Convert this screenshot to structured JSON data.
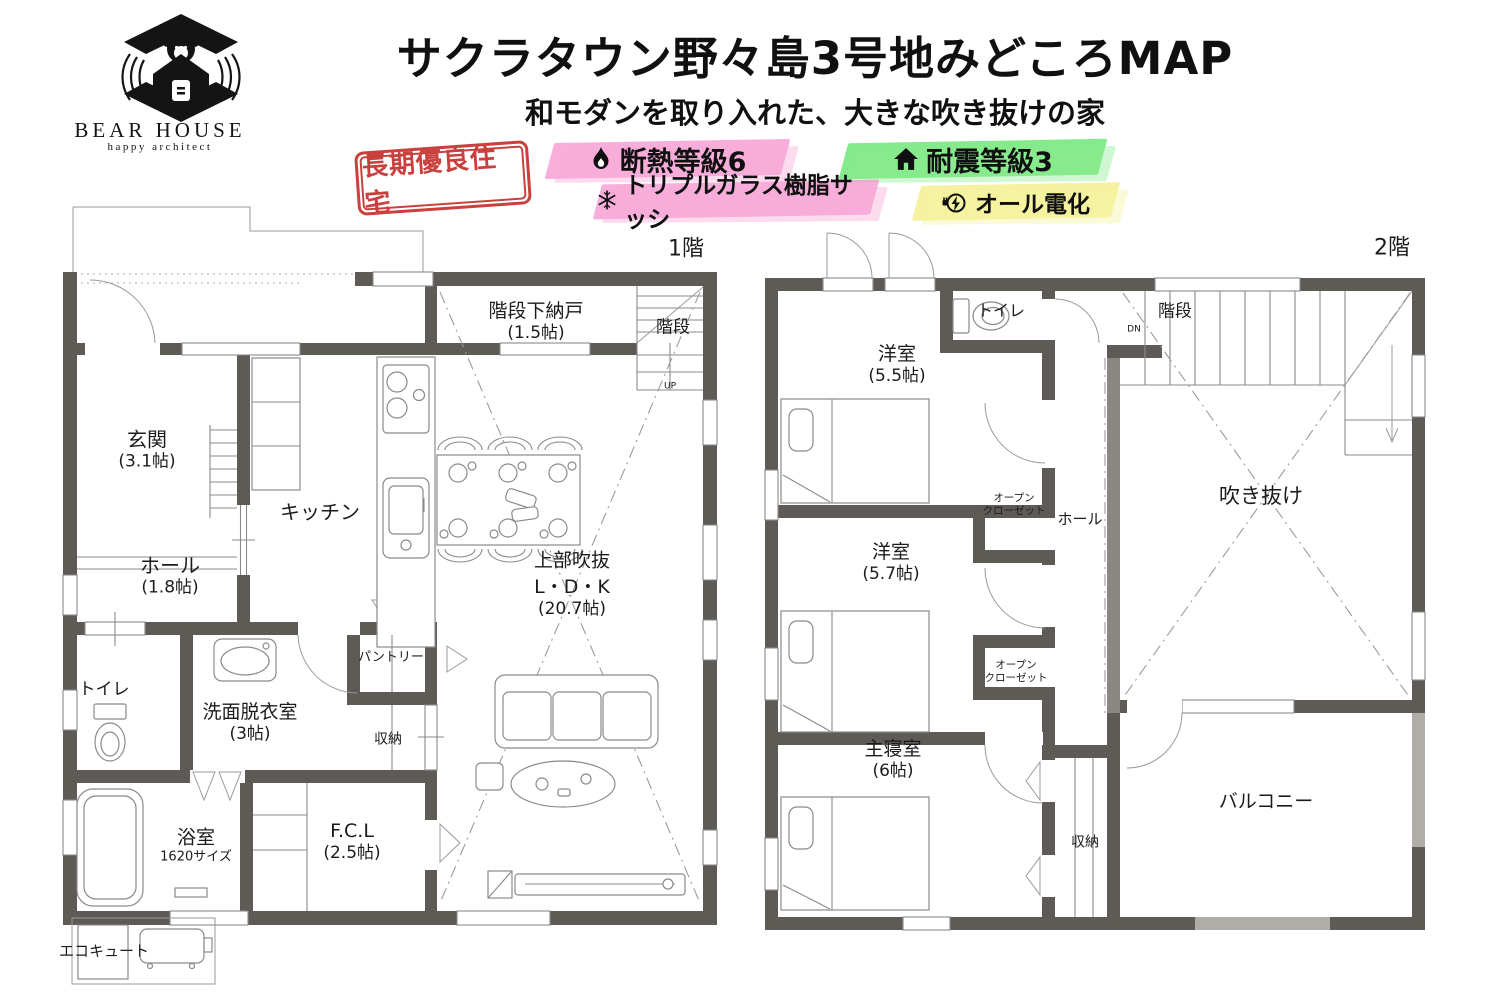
{
  "header": {
    "logo": {
      "name": "BEAR HOUSE",
      "tagline": "happy architect"
    },
    "title": "サクラタウン野々島3号地みどころMAP",
    "subtitle": "和モダンを取り入れた、大きな吹き抜けの家",
    "stamp": "長期優良住宅",
    "badges": [
      {
        "icon": "flame-icon",
        "label": "断熱等級6",
        "highlight_color": "#f48fcd"
      },
      {
        "icon": "house-icon",
        "label": "耐震等級3",
        "highlight_color": "#55e25e"
      },
      {
        "icon": "snowflake-icon",
        "label": "トリプルガラス樹脂サッシ",
        "highlight_color": "#f48fcd"
      },
      {
        "icon": "plug-bolt-icon",
        "label": "オール電化",
        "highlight_color": "#f1ec7c"
      }
    ]
  },
  "colors": {
    "wall_gray": "#5e5a56",
    "stamp_red": "#c5312e",
    "railing_gray": "#b0aca7"
  },
  "floor1": {
    "label": "1階",
    "stair_mark": "UP",
    "rooms": {
      "genkan": {
        "name": "玄関",
        "size": "(3.1帖)"
      },
      "hall": {
        "name": "ホール",
        "size": "(1.8帖)"
      },
      "kitchen": {
        "name": "キッチン"
      },
      "stair_storage": {
        "name": "階段下納戸",
        "size": "(1.5帖)"
      },
      "stairs": {
        "name": "階段"
      },
      "void_note": {
        "name": "上部吹抜"
      },
      "ldk": {
        "name": "L・D・K",
        "size": "(20.7帖)"
      },
      "toilet": {
        "name": "トイレ"
      },
      "washroom": {
        "name": "洗面脱衣室",
        "size": "(3帖)"
      },
      "pantry": {
        "name": "パントリー"
      },
      "storage": {
        "name": "収納"
      },
      "bath": {
        "name": "浴室",
        "size": "1620サイズ"
      },
      "fcl": {
        "name": "F.C.L",
        "size": "(2.5帖)"
      },
      "ecocute": {
        "name": "エコキュート"
      }
    }
  },
  "floor2": {
    "label": "2階",
    "stair_mark": "DN",
    "rooms": {
      "toilet": {
        "name": "トイレ"
      },
      "bedroom55": {
        "name": "洋室",
        "size": "(5.5帖)"
      },
      "stairs": {
        "name": "階段"
      },
      "void": {
        "name": "吹き抜け"
      },
      "open_closet1": {
        "name": "オープン",
        "name2": "クローゼット"
      },
      "hall": {
        "name": "ホール"
      },
      "bedroom57": {
        "name": "洋室",
        "size": "(5.7帖)"
      },
      "open_closet2": {
        "name": "オープン",
        "name2": "クローゼット"
      },
      "master": {
        "name": "主寝室",
        "size": "(6帖)"
      },
      "storage": {
        "name": "収納"
      },
      "balcony": {
        "name": "バルコニー"
      }
    }
  }
}
